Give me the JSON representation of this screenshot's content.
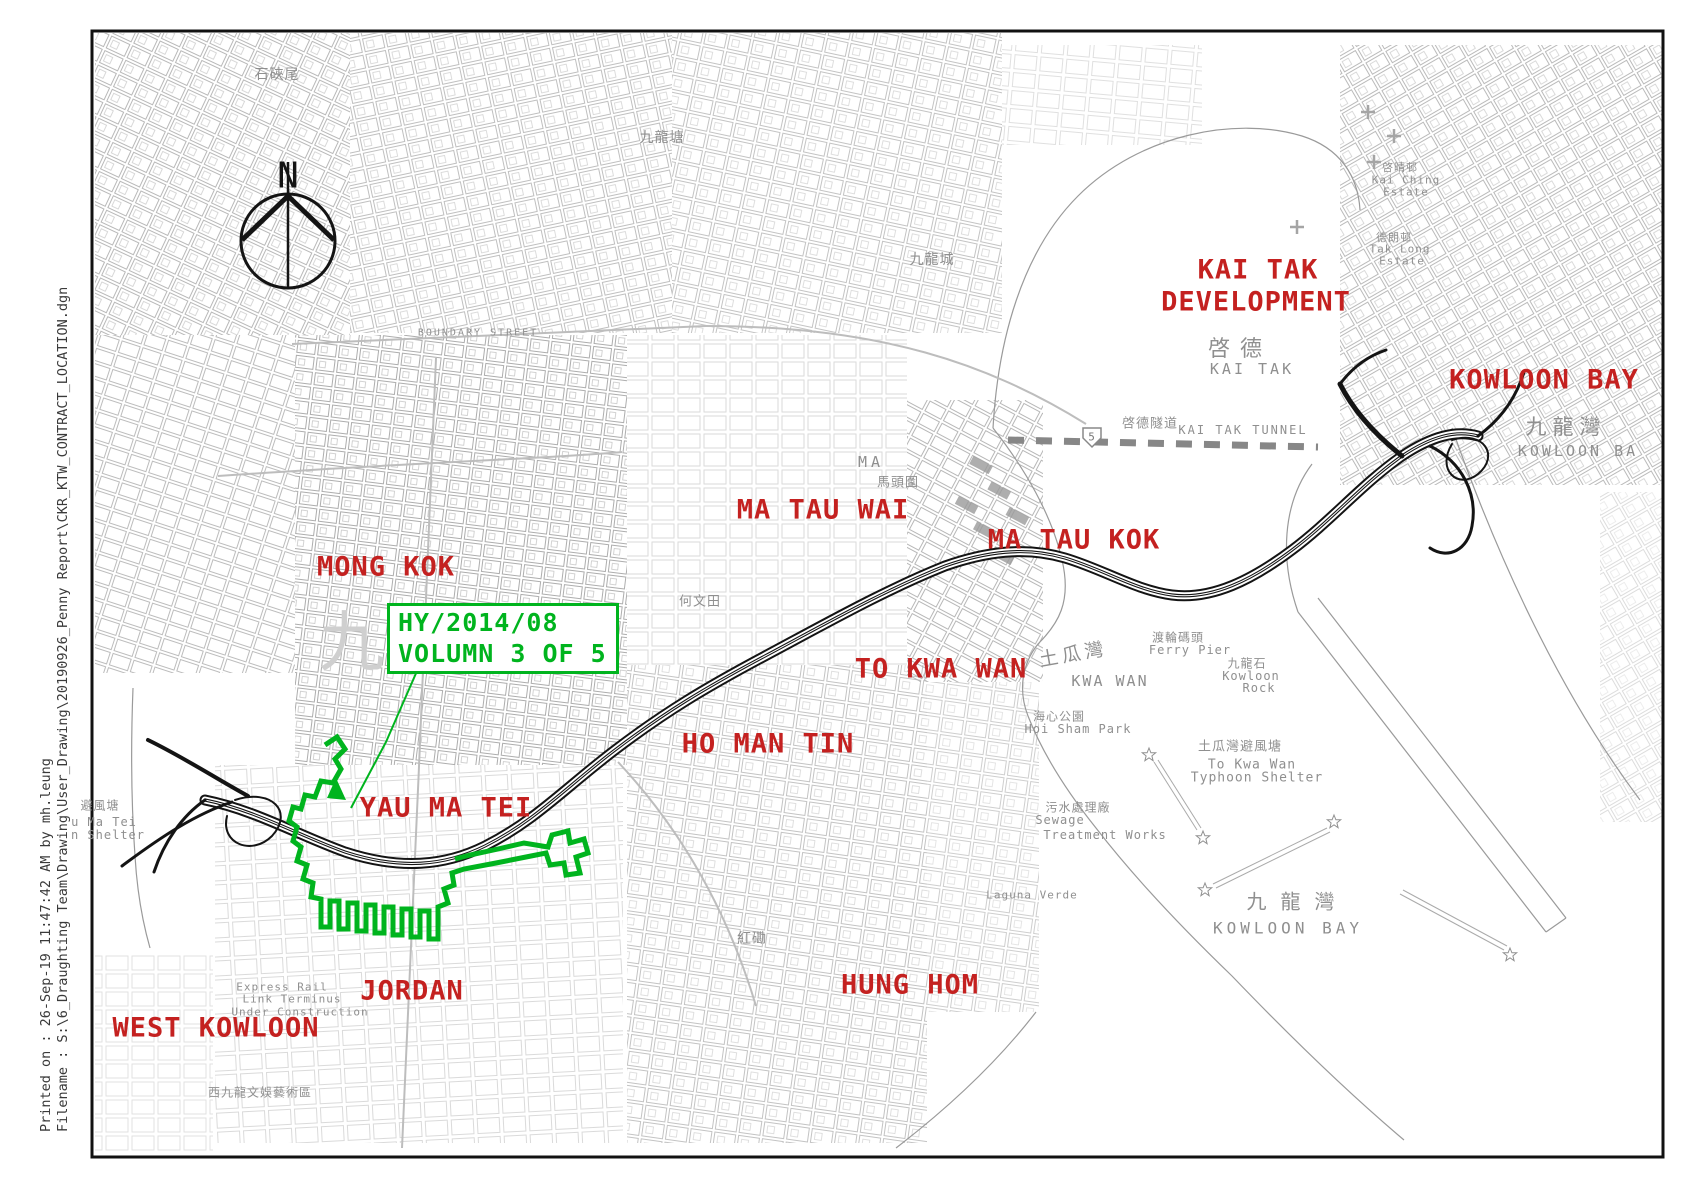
{
  "colors": {
    "label_red": "#c42120",
    "contract_green": "#00b41e",
    "route_black": "#141414",
    "gray_text": "#8f8f8f"
  },
  "sidebar": {
    "printed_on": "Printed on :  26-Sep-19 11:47:42  AM by  mh.leung",
    "filename": "Filename :  S:\\6_Draughting Team\\Drawing\\User_Drawing\\20190926_Penny Report\\CKR_KTW_CONTRACT_LOCATION.dgn"
  },
  "north_arrow": {
    "label": "N"
  },
  "contract_box": {
    "line1": "HY/2014/08",
    "line2": "VOLUMN 3 OF 5"
  },
  "district_labels": [
    {
      "id": "mong-kok",
      "t": "MONG KOK",
      "x": 386,
      "y": 567
    },
    {
      "id": "yau-ma-tei",
      "t": "YAU MA TEI",
      "x": 446,
      "y": 808
    },
    {
      "id": "ma-tau-wai",
      "t": "MA TAU WAI",
      "x": 823,
      "y": 510
    },
    {
      "id": "ma-tau-kok",
      "t": "MA TAU KOK",
      "x": 1074,
      "y": 540
    },
    {
      "id": "to-kwa-wan",
      "t": "TO KWA WAN",
      "x": 941,
      "y": 669
    },
    {
      "id": "ho-man-tin",
      "t": "HO MAN TIN",
      "x": 768,
      "y": 744
    },
    {
      "id": "kai-tak",
      "t": "KAI TAK",
      "x": 1258,
      "y": 270
    },
    {
      "id": "kai-tak-development",
      "t": "DEVELOPMENT",
      "x": 1256,
      "y": 302
    },
    {
      "id": "kowloon-bay-north",
      "t": "KOWLOON BAY",
      "x": 1544,
      "y": 380
    },
    {
      "id": "jordan",
      "t": "JORDAN",
      "x": 412,
      "y": 991
    },
    {
      "id": "west-kowloon",
      "t": "WEST KOWLOON",
      "x": 216,
      "y": 1028
    },
    {
      "id": "hung-hom",
      "t": "HUNG HOM",
      "x": 910,
      "y": 985
    }
  ],
  "map_labels": [
    {
      "t": "啓德",
      "x": 1240,
      "y": 347,
      "s": 22,
      "ls": 10
    },
    {
      "t": "KAI TAK",
      "x": 1252,
      "y": 369,
      "s": 15,
      "ls": 3
    },
    {
      "t": "九龍灣",
      "x": 1566,
      "y": 426,
      "s": 21,
      "ls": 6
    },
    {
      "t": "KOWLOON BA",
      "x": 1578,
      "y": 451,
      "s": 15,
      "ls": 3
    },
    {
      "t": "馬頭圍",
      "x": 898,
      "y": 481,
      "s": 13
    },
    {
      "t": "MA",
      "x": 871,
      "y": 462,
      "s": 15,
      "ls": 4
    },
    {
      "t": "土瓜灣",
      "x": 1073,
      "y": 653,
      "s": 19,
      "ls": 4,
      "rot": -10
    },
    {
      "t": "KWA WAN",
      "x": 1110,
      "y": 681,
      "s": 15,
      "ls": 2
    },
    {
      "t": "渡輪碼頭",
      "x": 1178,
      "y": 637,
      "s": 12
    },
    {
      "t": "Ferry Pier",
      "x": 1190,
      "y": 650,
      "s": 12
    },
    {
      "t": "九龍石",
      "x": 1247,
      "y": 663,
      "s": 12
    },
    {
      "t": "Kowloon",
      "x": 1251,
      "y": 676,
      "s": 12
    },
    {
      "t": "Rock",
      "x": 1259,
      "y": 688,
      "s": 12
    },
    {
      "t": "海心公園",
      "x": 1059,
      "y": 716,
      "s": 12
    },
    {
      "t": "Hoi Sham Park",
      "x": 1078,
      "y": 729,
      "s": 12
    },
    {
      "t": "土瓜灣避風塘",
      "x": 1240,
      "y": 745,
      "s": 13
    },
    {
      "t": "To Kwa Wan",
      "x": 1252,
      "y": 765,
      "s": 13
    },
    {
      "t": "Typhoon Shelter",
      "x": 1257,
      "y": 778,
      "s": 13
    },
    {
      "t": "污水處理廠",
      "x": 1078,
      "y": 807,
      "s": 12
    },
    {
      "t": "Sewage",
      "x": 1060,
      "y": 820,
      "s": 12
    },
    {
      "t": "Treatment Works",
      "x": 1105,
      "y": 835,
      "s": 12
    },
    {
      "t": "九 龍 灣",
      "x": 1291,
      "y": 900,
      "s": 20
    },
    {
      "t": "KOWLOON BAY",
      "x": 1288,
      "y": 928,
      "s": 16,
      "ls": 4
    },
    {
      "t": "避風塘",
      "x": 100,
      "y": 805,
      "s": 12
    },
    {
      "t": "u Ma Tei",
      "x": 104,
      "y": 822,
      "s": 12
    },
    {
      "t": "n Shelter",
      "x": 108,
      "y": 835,
      "s": 12
    },
    {
      "t": "啓德隧道",
      "x": 1150,
      "y": 422,
      "s": 13
    },
    {
      "t": "KAI TAK TUNNEL",
      "x": 1243,
      "y": 430,
      "s": 12,
      "ls": 2
    },
    {
      "t": "石硤尾",
      "x": 277,
      "y": 74,
      "s": 14
    },
    {
      "t": "九龍塘",
      "x": 662,
      "y": 137,
      "s": 14
    },
    {
      "t": "九龍城",
      "x": 932,
      "y": 259,
      "s": 14
    },
    {
      "t": "BOUNDARY STREET",
      "x": 478,
      "y": 333,
      "s": 10,
      "ls": 2
    },
    {
      "t": "西九龍文娛藝術區",
      "x": 260,
      "y": 1092,
      "s": 12
    },
    {
      "t": "Express Rail",
      "x": 282,
      "y": 987,
      "s": 11
    },
    {
      "t": "Link Terminus",
      "x": 292,
      "y": 999,
      "s": 11
    },
    {
      "t": "Under Construction",
      "x": 300,
      "y": 1012,
      "s": 11
    },
    {
      "t": "何文田",
      "x": 700,
      "y": 600,
      "s": 13
    },
    {
      "t": "紅磡",
      "x": 752,
      "y": 938,
      "s": 14
    },
    {
      "t": "啓晴邨",
      "x": 1400,
      "y": 167,
      "s": 11
    },
    {
      "t": "Kai Ching",
      "x": 1406,
      "y": 180,
      "s": 11
    },
    {
      "t": "Estate",
      "x": 1406,
      "y": 192,
      "s": 11
    },
    {
      "t": "德朗邨",
      "x": 1394,
      "y": 237,
      "s": 11
    },
    {
      "t": "Tak Long",
      "x": 1400,
      "y": 249,
      "s": 11
    },
    {
      "t": "Estate",
      "x": 1402,
      "y": 261,
      "s": 11
    },
    {
      "t": "Laguna Verde",
      "x": 1032,
      "y": 895,
      "s": 11
    },
    {
      "t": "九",
      "x": 352,
      "y": 637,
      "s": 66,
      "c": "#cfcfcf"
    },
    {
      "t": "5",
      "x": 1092,
      "y": 437,
      "s": 11,
      "c": "#777777"
    }
  ]
}
